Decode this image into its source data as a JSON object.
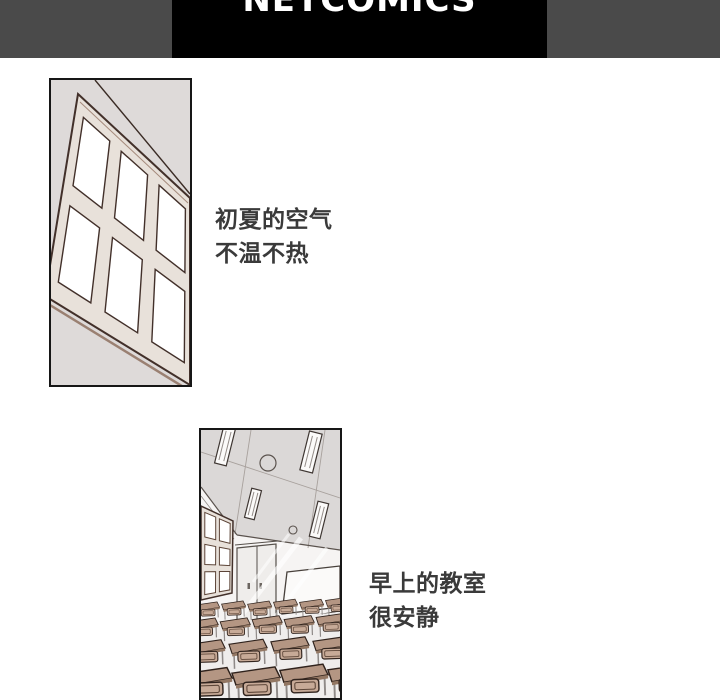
{
  "header": {
    "logo_text": "NETCOMICS",
    "bar_color": "#4a4a4a",
    "logo_bg": "#000000",
    "logo_color": "#ffffff"
  },
  "panels": {
    "panel1": {
      "caption": {
        "line1": "初夏的空气",
        "line2": "不温不热"
      }
    },
    "panel2": {
      "caption": {
        "line1": "早上的教室",
        "line2": "很安静"
      }
    }
  },
  "art_colors": {
    "page_background": "#ffffff",
    "panel_border": "#161616",
    "wall_gray": "#dedad9",
    "ceiling_gray": "#dbd8d7",
    "line_brown": "#42302a",
    "frame_beige": "#e8e1da",
    "desk_tan": "#b49683",
    "chair_tan": "#c7aa97",
    "caption_text": "#3a3a3a"
  }
}
